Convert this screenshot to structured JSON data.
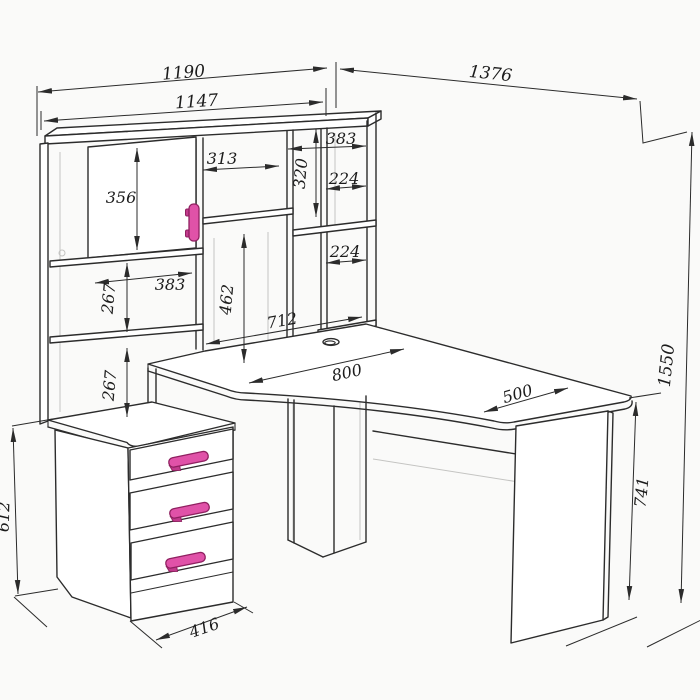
{
  "drawing": {
    "kind": "furniture-dimension-drawing",
    "subject": "corner-computer-desk-with-hutch-and-drawer-unit"
  },
  "colors": {
    "background": "#fafaf9",
    "line": "#2c2c2c",
    "hidden_line": "#c4c4c2",
    "handle_fill": "#e052a8",
    "handle_outline": "#8f2060"
  },
  "dims": {
    "d1190": "1190",
    "d1147": "1147",
    "d1376": "1376",
    "d1550": "1550",
    "d356": "356",
    "d313": "313",
    "d383_top": "383",
    "d320": "320",
    "d224_a": "224",
    "d224_b": "224",
    "d383_left": "383",
    "d267_a": "267",
    "d267_b": "267",
    "d462": "462",
    "d712": "712",
    "d800": "800",
    "d500": "500",
    "d741": "741",
    "d612": "612",
    "d416": "416"
  },
  "components": {
    "hutch": "upper shelving hutch",
    "desktop": "corner desktop",
    "drawer_unit": "three-drawer pedestal",
    "door": "hutch cabinet door",
    "grommet": "cable grommet"
  }
}
